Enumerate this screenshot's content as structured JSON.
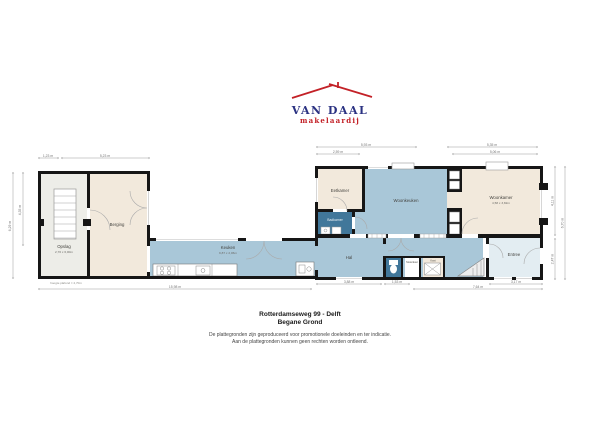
{
  "logo": {
    "name": "VAN DAAL",
    "tagline": "makelaardij"
  },
  "footer": {
    "title": "Rotterdamseweg 99 - Delft",
    "subtitle": "Begane Grond",
    "disclaimer1": "De plattegronden zijn geproduceerd voor promotionele doeleinden en ter indicatie.",
    "disclaimer2": "Aan de plattegronden kunnen geen rechten worden ontleend."
  },
  "rooms": {
    "opslag": {
      "label": "Opslag",
      "dims": "2,70 x 6,00m"
    },
    "berging": {
      "label": "Berging"
    },
    "keuken": {
      "label": "Keuken",
      "dims": "9,87 x 2,06m"
    },
    "eetkamer": {
      "label": "Eetkamer"
    },
    "badkamer": {
      "label": "Badkamer"
    },
    "woonkeuken": {
      "label": "Woonkeuken"
    },
    "woonkamer": {
      "label": "Woonkamer",
      "dims": "4,58 x 3,82m"
    },
    "hal": {
      "label": "Hal"
    },
    "meterkast": {
      "label": "Meterkast"
    },
    "kast": {
      "label": "Kast"
    },
    "entree": {
      "label": "Entree"
    }
  },
  "notes": {
    "ceiling_note": "hoogte plafond = 2,70m"
  },
  "dims": {
    "t1": "1,23 m",
    "t2": "5,23 m",
    "t3": "5,93 m",
    "t4": "5,35 m",
    "t5": "2,59 m",
    "t6": "5,06 m",
    "b1": "15,98 m",
    "b2": "3,88 m",
    "b3": "1,53 m",
    "b4": "7,64 m",
    "b5": "3,17 m",
    "l1": "6,29 m",
    "l2": "4,35 m",
    "r1": "4,11 m",
    "r2": "2,47 m",
    "r3": "6,70 m"
  },
  "colors": {
    "wall": "#161616",
    "room_beige": "#f2e9dc",
    "room_grey": "#ededE8",
    "room_blue": "#a9c7d8",
    "room_darkblue": "#41779a",
    "room_entree": "#e3edf2",
    "logo_navy": "#2b3282",
    "logo_red": "#c32127",
    "dim_line": "#999999"
  }
}
